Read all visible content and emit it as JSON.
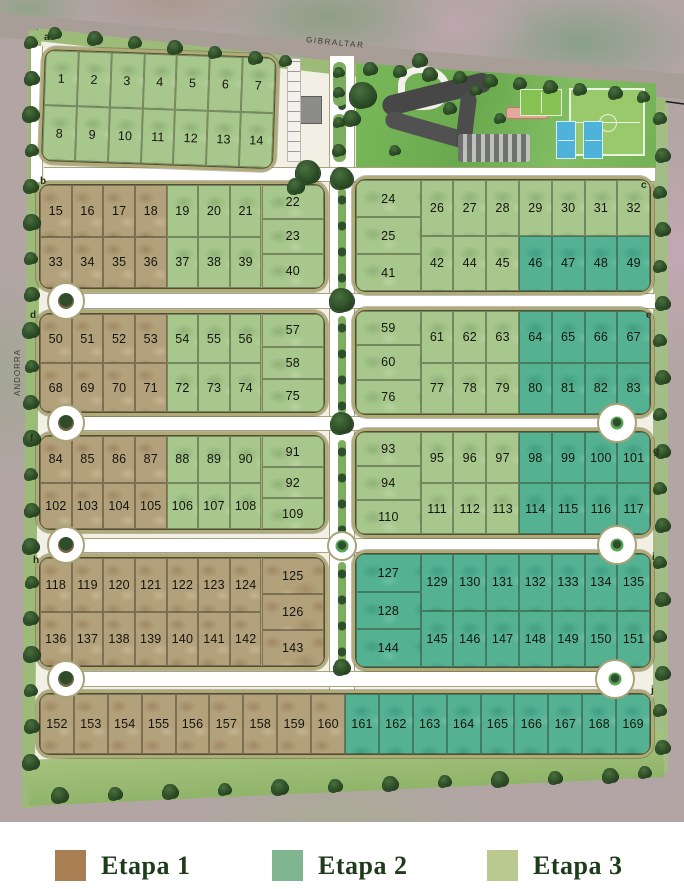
{
  "map": {
    "streets": {
      "top": "GIBRALTAR",
      "left": "ANDORRA"
    },
    "phase_colors": {
      "1": "#b3a17c",
      "2": "#54b293",
      "3": "#a7c78d"
    },
    "corner_labels": [
      {
        "label": "a",
        "x": 44,
        "y": 33
      },
      {
        "label": "b",
        "x": 40,
        "y": 177
      },
      {
        "label": "c",
        "x": 641,
        "y": 181
      },
      {
        "label": "d",
        "x": 30,
        "y": 311
      },
      {
        "label": "e",
        "x": 646,
        "y": 311
      },
      {
        "label": "f",
        "x": 30,
        "y": 434
      },
      {
        "label": "g",
        "x": 653,
        "y": 447
      },
      {
        "label": "h",
        "x": 33,
        "y": 556
      },
      {
        "label": "i",
        "x": 652,
        "y": 553
      },
      {
        "label": "j",
        "x": 651,
        "y": 686
      }
    ],
    "blocks": [
      {
        "id": "block-a",
        "x": 42,
        "y": 46,
        "w": 238,
        "h": 118,
        "rot": 2,
        "rows": [
          [
            [
              1,
              3
            ],
            [
              2,
              3
            ],
            [
              3,
              3
            ],
            [
              4,
              3
            ],
            [
              5,
              3
            ],
            [
              6,
              3
            ],
            [
              7,
              3
            ]
          ],
          [
            [
              8,
              3
            ],
            [
              9,
              3
            ],
            [
              10,
              3
            ],
            [
              11,
              3
            ],
            [
              12,
              3
            ],
            [
              13,
              3
            ],
            [
              14,
              3
            ]
          ]
        ]
      },
      {
        "id": "block-b-left",
        "x": 36,
        "y": 181,
        "w": 292,
        "h": 111,
        "stack": {
          "side": "right",
          "cells": [
            [
              22,
              3
            ],
            [
              23,
              3
            ],
            [
              40,
              3
            ]
          ]
        },
        "rows": [
          [
            [
              15,
              1
            ],
            [
              16,
              1
            ],
            [
              17,
              1
            ],
            [
              18,
              1
            ],
            [
              19,
              3
            ],
            [
              20,
              3
            ],
            [
              21,
              3
            ]
          ],
          [
            [
              33,
              1
            ],
            [
              34,
              1
            ],
            [
              35,
              1
            ],
            [
              36,
              1
            ],
            [
              37,
              3
            ],
            [
              38,
              3
            ],
            [
              39,
              3
            ]
          ]
        ]
      },
      {
        "id": "block-b-right",
        "x": 352,
        "y": 176,
        "w": 302,
        "h": 119,
        "stack": {
          "side": "left",
          "cells": [
            [
              24,
              3
            ],
            [
              25,
              3
            ],
            [
              41,
              3
            ]
          ]
        },
        "rows": [
          [
            [
              26,
              3
            ],
            [
              27,
              3
            ],
            [
              28,
              3
            ],
            [
              29,
              3
            ],
            [
              30,
              3
            ],
            [
              31,
              3
            ],
            [
              32,
              3
            ]
          ],
          [
            [
              42,
              3
            ],
            [
              44,
              3
            ],
            [
              45,
              3
            ],
            [
              46,
              2
            ],
            [
              47,
              2
            ],
            [
              48,
              2
            ],
            [
              49,
              2
            ]
          ]
        ]
      },
      {
        "id": "block-d-left",
        "x": 36,
        "y": 310,
        "w": 292,
        "h": 106,
        "stack": {
          "side": "right",
          "cells": [
            [
              57,
              3
            ],
            [
              58,
              3
            ],
            [
              75,
              3
            ]
          ]
        },
        "rows": [
          [
            [
              50,
              1
            ],
            [
              51,
              1
            ],
            [
              52,
              1
            ],
            [
              53,
              1
            ],
            [
              54,
              3
            ],
            [
              55,
              3
            ],
            [
              56,
              3
            ]
          ],
          [
            [
              68,
              1
            ],
            [
              69,
              1
            ],
            [
              70,
              1
            ],
            [
              71,
              1
            ],
            [
              72,
              3
            ],
            [
              73,
              3
            ],
            [
              74,
              3
            ]
          ]
        ]
      },
      {
        "id": "block-d-right",
        "x": 352,
        "y": 307,
        "w": 302,
        "h": 111,
        "stack": {
          "side": "left",
          "cells": [
            [
              59,
              3
            ],
            [
              60,
              3
            ],
            [
              76,
              3
            ]
          ]
        },
        "rows": [
          [
            [
              61,
              3
            ],
            [
              62,
              3
            ],
            [
              63,
              3
            ],
            [
              64,
              2
            ],
            [
              65,
              2
            ],
            [
              66,
              2
            ],
            [
              67,
              2
            ]
          ],
          [
            [
              77,
              3
            ],
            [
              78,
              3
            ],
            [
              79,
              3
            ],
            [
              80,
              2
            ],
            [
              81,
              2
            ],
            [
              82,
              2
            ],
            [
              83,
              2
            ]
          ]
        ]
      },
      {
        "id": "block-f-left",
        "x": 36,
        "y": 432,
        "w": 292,
        "h": 101,
        "stack": {
          "side": "right",
          "cells": [
            [
              91,
              3
            ],
            [
              92,
              3
            ],
            [
              109,
              3
            ]
          ]
        },
        "rows": [
          [
            [
              84,
              1
            ],
            [
              85,
              1
            ],
            [
              86,
              1
            ],
            [
              87,
              1
            ],
            [
              88,
              3
            ],
            [
              89,
              3
            ],
            [
              90,
              3
            ]
          ],
          [
            [
              102,
              1
            ],
            [
              103,
              1
            ],
            [
              104,
              1
            ],
            [
              105,
              1
            ],
            [
              106,
              3
            ],
            [
              107,
              3
            ],
            [
              108,
              3
            ]
          ]
        ]
      },
      {
        "id": "block-f-right",
        "x": 352,
        "y": 428,
        "w": 302,
        "h": 110,
        "stack": {
          "side": "left",
          "cells": [
            [
              93,
              3
            ],
            [
              94,
              3
            ],
            [
              110,
              3
            ]
          ]
        },
        "rows": [
          [
            [
              95,
              3
            ],
            [
              96,
              3
            ],
            [
              97,
              3
            ],
            [
              98,
              2
            ],
            [
              99,
              2
            ],
            [
              100,
              2
            ],
            [
              101,
              2
            ]
          ],
          [
            [
              111,
              3
            ],
            [
              112,
              3
            ],
            [
              113,
              3
            ],
            [
              114,
              2
            ],
            [
              115,
              2
            ],
            [
              116,
              2
            ],
            [
              117,
              2
            ]
          ]
        ]
      },
      {
        "id": "block-h-left",
        "x": 36,
        "y": 554,
        "w": 292,
        "h": 116,
        "stack": {
          "side": "right",
          "cells": [
            [
              125,
              1
            ],
            [
              126,
              1
            ],
            [
              143,
              1
            ]
          ]
        },
        "rows": [
          [
            [
              118,
              1
            ],
            [
              119,
              1
            ],
            [
              120,
              1
            ],
            [
              121,
              1
            ],
            [
              122,
              1
            ],
            [
              123,
              1
            ],
            [
              124,
              1
            ]
          ],
          [
            [
              136,
              1
            ],
            [
              137,
              1
            ],
            [
              138,
              1
            ],
            [
              139,
              1
            ],
            [
              140,
              1
            ],
            [
              141,
              1
            ],
            [
              142,
              1
            ]
          ]
        ]
      },
      {
        "id": "block-h-right",
        "x": 352,
        "y": 550,
        "w": 302,
        "h": 121,
        "stack": {
          "side": "left",
          "cells": [
            [
              127,
              2
            ],
            [
              128,
              2
            ],
            [
              144,
              2
            ]
          ]
        },
        "rows": [
          [
            [
              129,
              2
            ],
            [
              130,
              2
            ],
            [
              131,
              2
            ],
            [
              132,
              2
            ],
            [
              133,
              2
            ],
            [
              134,
              2
            ],
            [
              135,
              2
            ]
          ],
          [
            [
              145,
              2
            ],
            [
              146,
              2
            ],
            [
              147,
              2
            ],
            [
              148,
              2
            ],
            [
              149,
              2
            ],
            [
              150,
              2
            ],
            [
              151,
              2
            ]
          ]
        ]
      },
      {
        "id": "block-j",
        "x": 36,
        "y": 690,
        "w": 618,
        "h": 68,
        "rows": [
          [
            [
              152,
              1
            ],
            [
              153,
              1
            ],
            [
              154,
              1
            ],
            [
              155,
              1
            ],
            [
              156,
              1
            ],
            [
              157,
              1
            ],
            [
              158,
              1
            ],
            [
              159,
              1
            ],
            [
              160,
              1
            ],
            [
              161,
              2
            ],
            [
              162,
              2
            ],
            [
              163,
              2
            ],
            [
              164,
              2
            ],
            [
              165,
              2
            ],
            [
              166,
              2
            ],
            [
              167,
              2
            ],
            [
              168,
              2
            ],
            [
              169,
              2
            ]
          ]
        ]
      }
    ]
  },
  "legend": {
    "items": [
      {
        "label": "Etapa 1",
        "color": "#a87e52"
      },
      {
        "label": "Etapa 2",
        "color": "#7fb591"
      },
      {
        "label": "Etapa 3",
        "color": "#b9c98f"
      }
    ]
  }
}
